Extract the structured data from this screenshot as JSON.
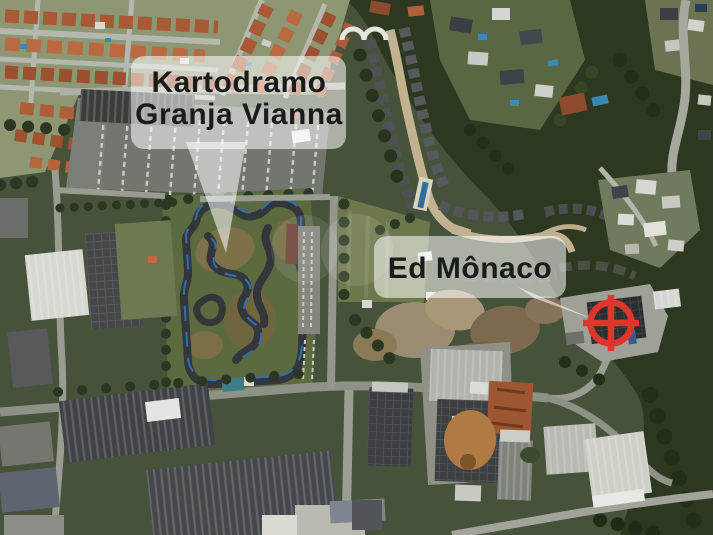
{
  "callouts": {
    "kartodromo": {
      "line1": "Kartodramo",
      "line2": "Granja Vianna"
    },
    "ed_monaco": {
      "label": "Ed Mônaco"
    }
  },
  "marker": {
    "name": "location-crosshair",
    "color": "#DE362B"
  },
  "style": {
    "label_text_color": "#1B1B1B",
    "label_bg_color": "#FFFFFF",
    "track_asphalt_color": "#33363A",
    "track_barrier_color": "#2E6FB5"
  }
}
